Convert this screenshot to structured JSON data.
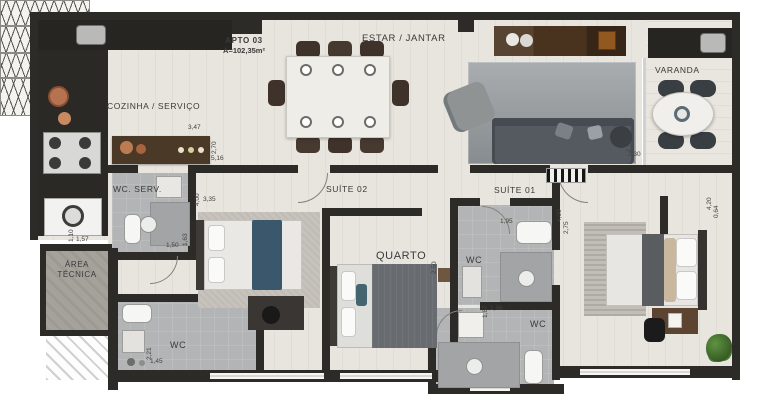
{
  "title": {
    "apto": "APTO 03",
    "area": "Á=102,35m²"
  },
  "rooms": {
    "estar": "ESTAR / JANTAR",
    "cozinha": "COZINHA / SERVIÇO",
    "varanda": "VARANDA",
    "wc_serv": "WC. SERV.",
    "suite02": "SUÍTE 02",
    "suite01": "SUÍTE 01",
    "quarto": "QUARTO",
    "wc_suite01": "WC",
    "wc_quarto": "WC",
    "wc_social": "WC",
    "area_tecnica_line1": "ÁREA",
    "area_tecnica_line2": "TÉCNICA"
  },
  "dimensions": {
    "kitchen_w": "3,47",
    "kitchen_h": "2,70",
    "kitchen_len": "5,16",
    "suite02_depth": "4,00",
    "suite02_width": "3,35",
    "wcserv_width": "1,50",
    "wcserv_depth": "1,63",
    "laundry_depth": "1,10",
    "laundry_width": "1,57",
    "wc_left_depth": "2,21",
    "wc_left_width": "1,45",
    "quarto_depth": "2,50",
    "wc_quarto_depth": "1,67",
    "wc_quarto_width": "1,96",
    "wc_suite01_width": "1,95",
    "suite01_depth": "4,00",
    "suite01_closet": "2,75",
    "varanda_depth": "2,53",
    "varanda_width": "2,30",
    "right_wall_a": "4,20",
    "right_wall_b": "0,64"
  },
  "colors": {
    "wall": "#2d2b28",
    "floor_wood": "#e8e4de",
    "bathroom_tile": "#b3b4b5",
    "concrete": "#a5a29c",
    "accent_blue": "#3a576b",
    "dark_wood": "#4f3a27",
    "plant_green": "#4c7a38"
  }
}
